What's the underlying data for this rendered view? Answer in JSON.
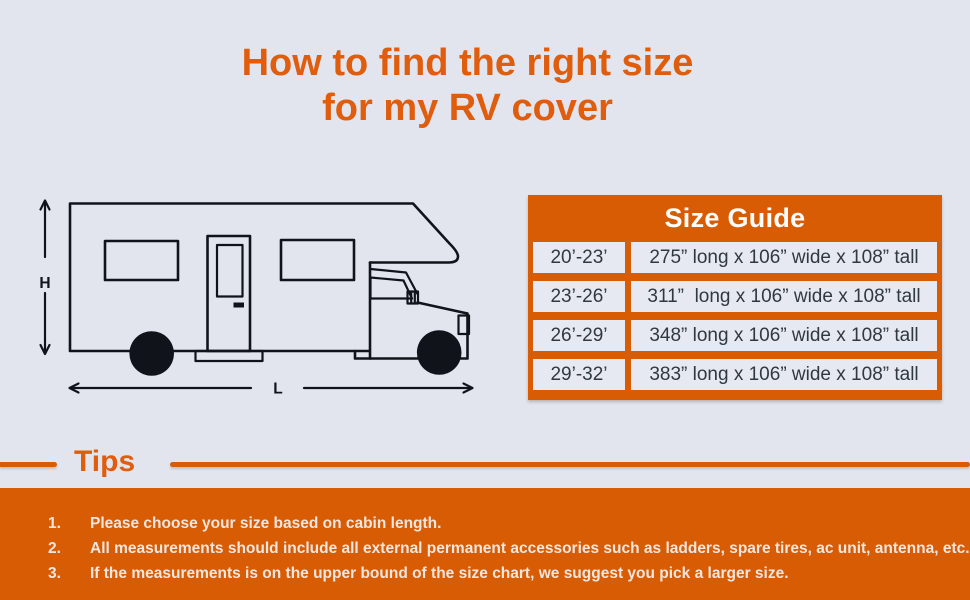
{
  "title": {
    "line1": "How to find the right size",
    "line2": "for my RV cover"
  },
  "diagram": {
    "height_label": "H",
    "length_label": "L"
  },
  "size_guide": {
    "title": "Size Guide",
    "rows": [
      {
        "size": "20’-23’",
        "dims": "275” long x 106” wide x 108” tall"
      },
      {
        "size": "23’-26’",
        "dims": "311”  long x 106” wide x 108” tall"
      },
      {
        "size": "26’-29’",
        "dims": "348” long x 106” wide x 108” tall"
      },
      {
        "size": "29’-32’",
        "dims": "383” long x 106” wide x 108” tall"
      }
    ]
  },
  "tips": {
    "heading": "Tips",
    "items": [
      {
        "num": "1.",
        "text": "Please choose your size based on cabin length."
      },
      {
        "num": "2.",
        "text": "All measurements should include all external permanent accessories such as ladders, spare tires, ac unit, antenna, etc."
      },
      {
        "num": "3.",
        "text": "If the measurements is on the upper bound of the size chart, we suggest you pick a larger size."
      }
    ]
  },
  "colors": {
    "background": "#E2E5EE",
    "accent": "#D85C04",
    "title": "#DF5D0D",
    "cell": "#E6E9F2",
    "table_text": "#303842",
    "footer_text": "#F2E7E0",
    "line": "#10141A"
  }
}
